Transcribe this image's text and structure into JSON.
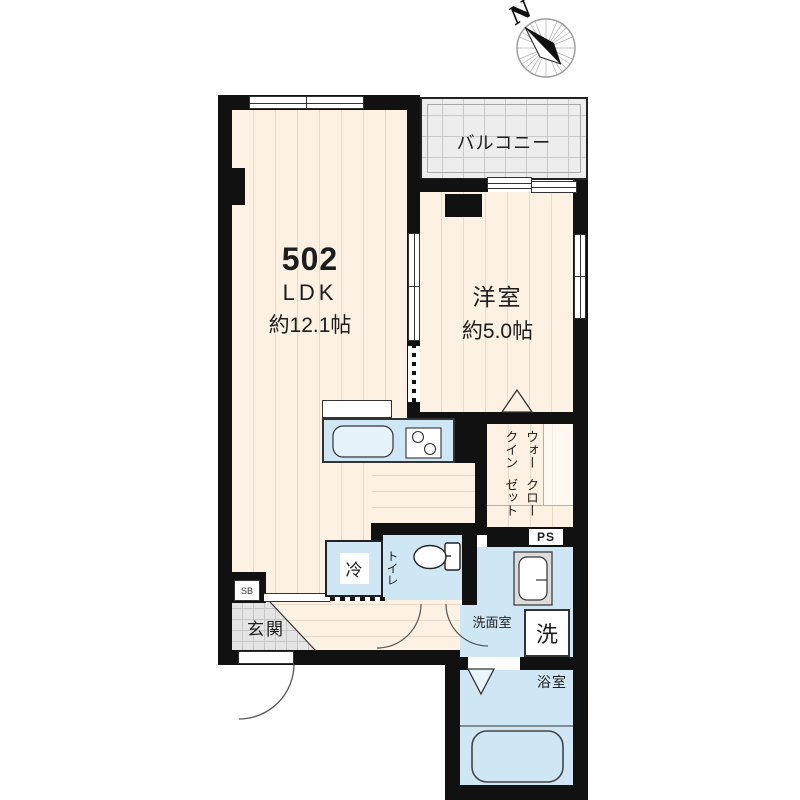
{
  "compass": {
    "north_label": "N"
  },
  "unit": {
    "number": "502",
    "layout_type": "LDK",
    "area_label": "約12.1帖"
  },
  "rooms": {
    "western_room": {
      "name": "洋室",
      "area_label": "約5.0帖"
    },
    "balcony": {
      "name": "バルコニー"
    },
    "walk_in_closet": {
      "name_line1": "ウォークイン",
      "name_line2": "クローゼット"
    },
    "toilet": {
      "name": "トイレ"
    },
    "entrance": {
      "name": "玄関"
    },
    "washroom": {
      "name": "洗面室"
    },
    "bathroom": {
      "name": "浴室"
    }
  },
  "fixtures": {
    "refrigerator_label": "冷",
    "washing_machine_label": "洗",
    "pipe_space_label": "PS",
    "shoe_box_label": "SB"
  },
  "colors": {
    "wall": "#111111",
    "wood_floor": "#fcf1e3",
    "wood_stripe": "#e8dac6",
    "wet_area": "#cfe7f5",
    "balcony_floor": "#ededed",
    "entrance_tile": "#e4e4e4"
  }
}
